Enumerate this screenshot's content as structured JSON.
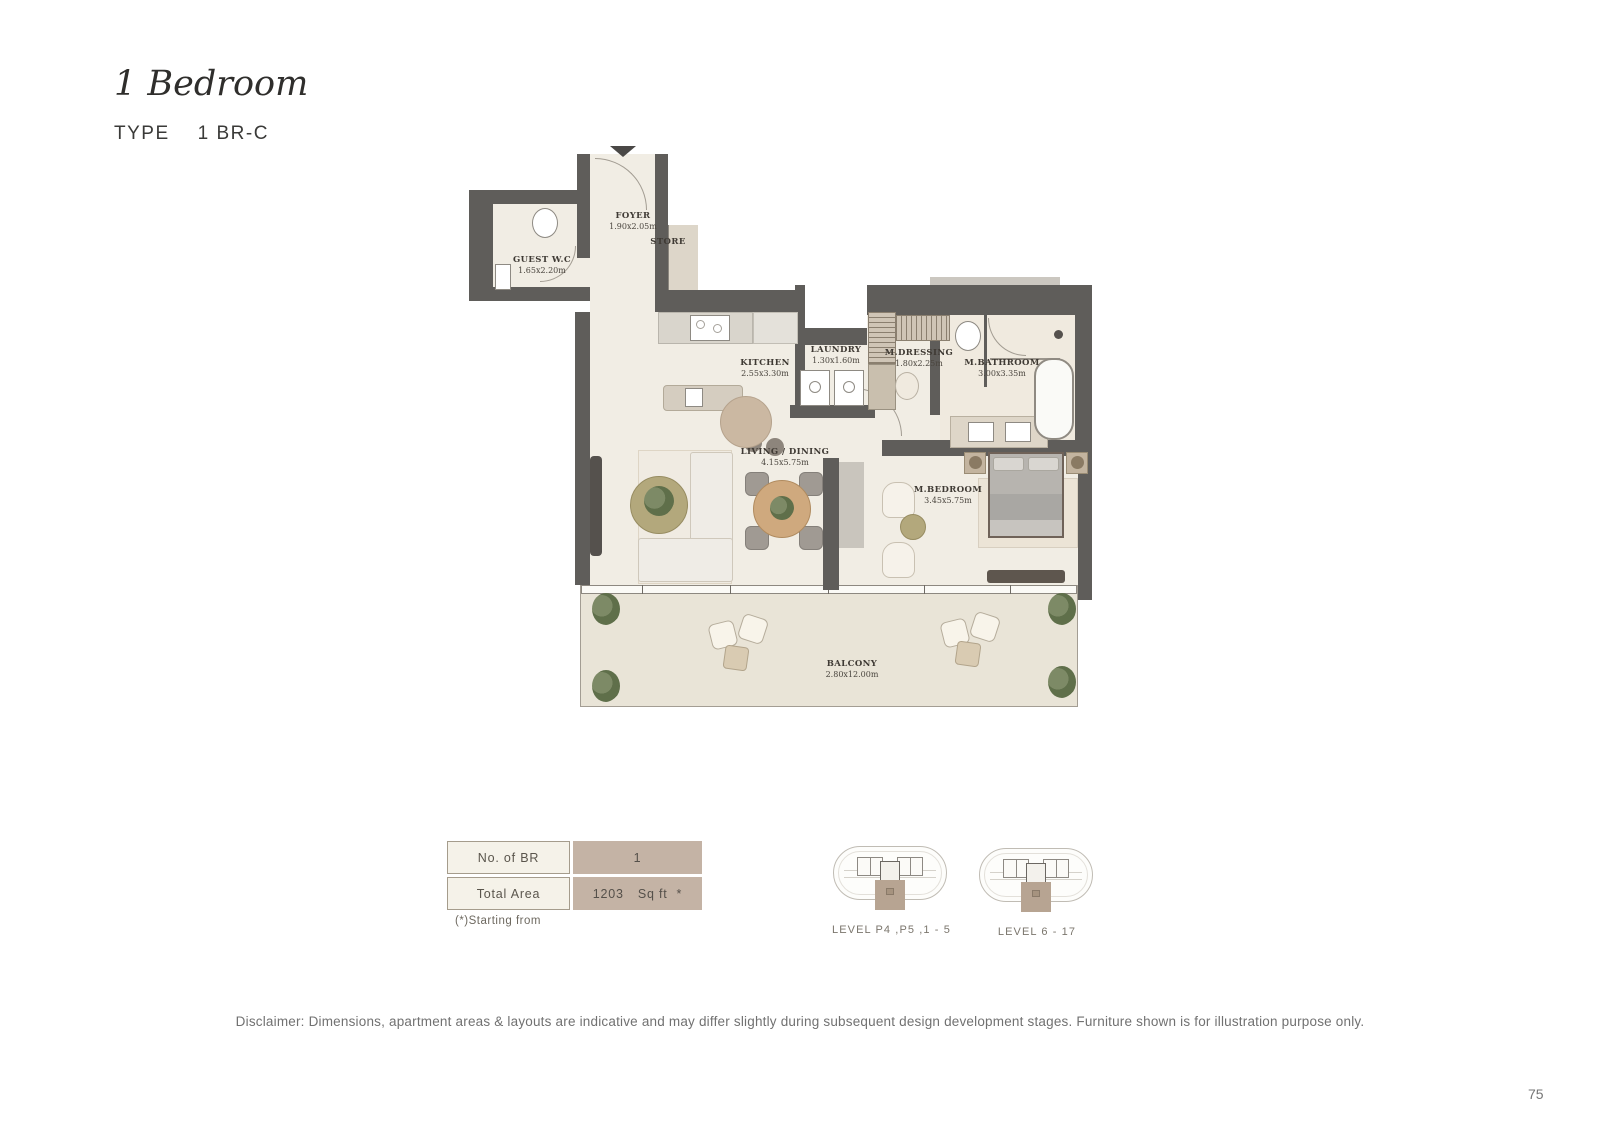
{
  "header": {
    "title": "1 Bedroom",
    "type_label": "TYPE",
    "type_value": "1 BR-C"
  },
  "floorplan": {
    "rooms": [
      {
        "name": "FOYER",
        "dims": "1.90x2.05m"
      },
      {
        "name": "STORE",
        "dims": ""
      },
      {
        "name": "GUEST W.C",
        "dims": "1.65x2.20m"
      },
      {
        "name": "KITCHEN",
        "dims": "2.55x3.30m"
      },
      {
        "name": "LAUNDRY",
        "dims": "1.30x1.60m"
      },
      {
        "name": "M.DRESSING",
        "dims": "1.80x2.25m"
      },
      {
        "name": "M.BATHROOM",
        "dims": "3.00x3.35m"
      },
      {
        "name": "LIVING / DINING",
        "dims": "4.15x5.75m"
      },
      {
        "name": "M.BEDROOM",
        "dims": "3.45x5.75m"
      },
      {
        "name": "BALCONY",
        "dims": "2.80x12.00m"
      }
    ]
  },
  "info_table": {
    "rows": [
      {
        "label": "No. of BR",
        "value": "1",
        "unit": "",
        "marker": ""
      },
      {
        "label": "Total Area",
        "value": "1203",
        "unit": "Sq ft",
        "marker": "*"
      }
    ],
    "footnote": "(*)Starting from"
  },
  "key_plans": [
    {
      "label": "LEVEL P4 ,P5 ,1 - 5"
    },
    {
      "label": "LEVEL 6 - 17"
    }
  ],
  "footer": {
    "disclaimer": "Disclaimer: Dimensions, apartment areas & layouts are indicative and may differ slightly during subsequent design development stages. Furniture shown is for illustration purpose only.",
    "page_number": "75"
  },
  "colors": {
    "wall": "#5f5d5a",
    "floor": "#f1ede4",
    "balcony_floor": "#e9e4d7",
    "table_label_bg": "#f5f2e9",
    "table_value_bg": "#c4b3a5",
    "key_highlight": "#b7a492"
  }
}
